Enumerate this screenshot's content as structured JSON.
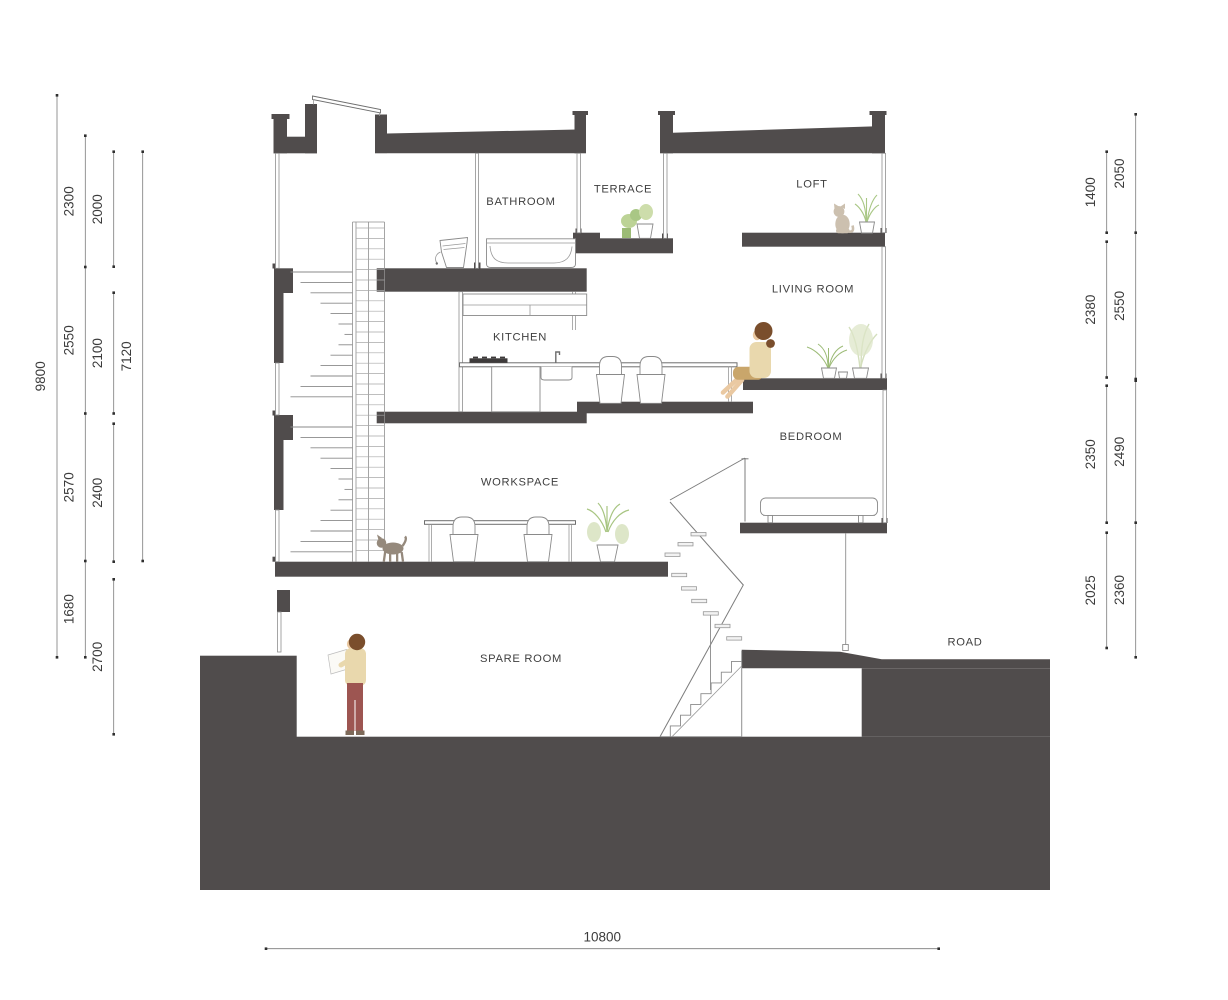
{
  "rooms": {
    "bathroom": "BATHROOM",
    "terrace": "TERRACE",
    "loft": "LOFT",
    "living_room": "LIVING ROOM",
    "kitchen": "KITCHEN",
    "bedroom": "BEDROOM",
    "workspace": "WORKSPACE",
    "spare_room": "SPARE ROOM",
    "road": "ROAD"
  },
  "dim": {
    "left": {
      "overall": "9800",
      "c2": [
        "2300",
        "2550",
        "2570",
        "1680"
      ],
      "c3": [
        "2000",
        "2100",
        "2400",
        "2700"
      ],
      "c4": [
        "7120"
      ]
    },
    "right": {
      "inner": [
        "1400",
        "2380",
        "2350",
        "2025"
      ],
      "outer": [
        "2050",
        "2550",
        "2490",
        "2360"
      ]
    },
    "bottom": "10800"
  },
  "colors": {
    "structure": "#504c4c",
    "text": "#3c3c3c",
    "skin": "#eac9a2",
    "hair": "#7a4e2c",
    "sweater": "#e9d8ad",
    "shorts": "#c9a66b",
    "pants": "#9d5551",
    "cat": "#ccc0af",
    "dog": "#95897c",
    "plant_green": "#9cbb76",
    "plant_light": "#bcd396",
    "plant_pale": "#d4dfbd"
  }
}
